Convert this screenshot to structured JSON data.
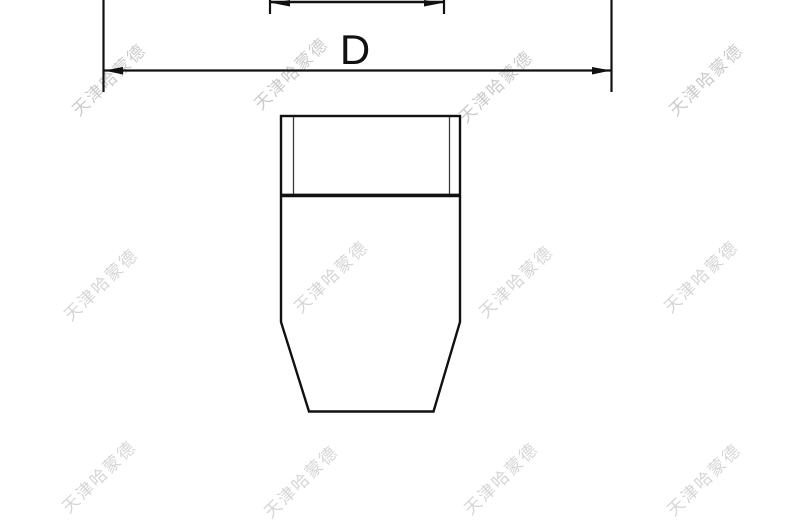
{
  "drawing": {
    "type": "technical-drawing",
    "dimensions": {
      "outer_label": "D"
    },
    "watermark": {
      "text": "天津哈蒙德",
      "color": "#cbcbcb"
    },
    "colors": {
      "line": "#111111",
      "thread_line": "#3a3a3a",
      "background": "#ffffff"
    }
  }
}
